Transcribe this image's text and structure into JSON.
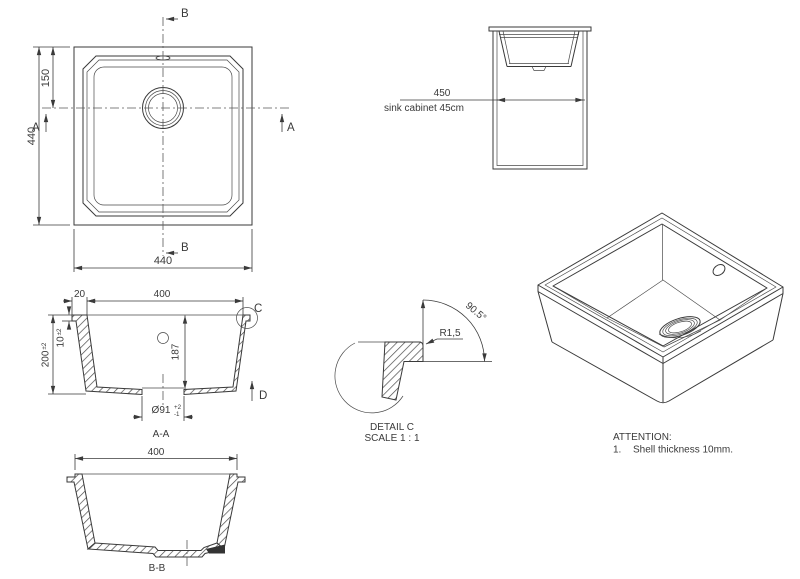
{
  "drawing": {
    "top_view": {
      "dim_overall_height": "440",
      "dim_drain_from_top": "150",
      "dim_overall_width": "440",
      "section_b": "B",
      "section_a": "A"
    },
    "cabinet_view": {
      "dim_width": "450",
      "label": "sink cabinet 45cm"
    },
    "section_aa": {
      "dim_rim": "20",
      "dim_inner_width": "400",
      "dim_rim_height": "10",
      "dim_rim_height_tol": "±2",
      "dim_total_height": "200",
      "dim_total_height_tol": "±2",
      "dim_bowl_depth": "187",
      "dim_drain_dia": "Ø91",
      "dim_drain_tol_upper": "+2",
      "dim_drain_tol_lower": "-1",
      "detail_label": "C",
      "arrow_label": "D",
      "view_label": "A-A"
    },
    "detail_c": {
      "radius_label": "R1,5",
      "angle_label": "90.5°",
      "title": "DETAIL C",
      "scale_label": "SCALE 1 : 1"
    },
    "section_bb": {
      "dim_inner_width": "400",
      "view_label": "B-B"
    },
    "attention": {
      "heading": "ATTENTION:",
      "note_number": "1.",
      "note_text": "Shell thickness 10mm."
    }
  }
}
